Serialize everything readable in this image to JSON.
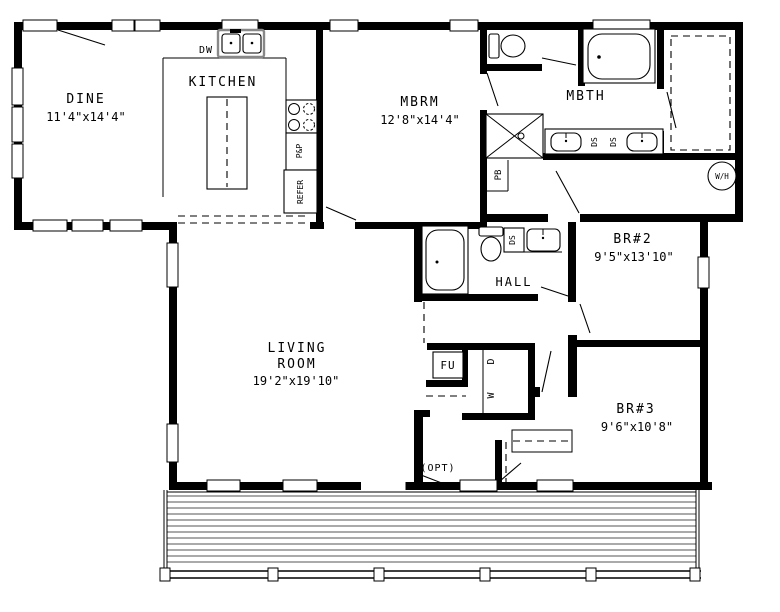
{
  "colors": {
    "line": "#000000",
    "background": "#ffffff",
    "plank": "#555555"
  },
  "rooms": {
    "dine": {
      "name": "DINE",
      "dims": "11'4\"x14'4\""
    },
    "kitchen": {
      "name": "KITCHEN"
    },
    "mbrm": {
      "name": "MBRM",
      "dims": "12'8\"x14'4\""
    },
    "mbth": {
      "name": "MBTH"
    },
    "living": {
      "name_line1": "LIVING",
      "name_line2": "ROOM",
      "dims": "19'2\"x19'10\""
    },
    "hall": {
      "name": "HALL"
    },
    "br2": {
      "name": "BR#2",
      "dims": "9'5\"x13'10\""
    },
    "br3": {
      "name": "BR#3",
      "dims": "9'6\"x10'8\""
    }
  },
  "fixtures": {
    "dishwasher": "DW",
    "pantry": "P&P",
    "refrigerator": "REFER",
    "plumbing_chase": "PB",
    "double_sink": "DS",
    "water_heater": "W/H",
    "furnace": "FU",
    "washer": "W",
    "dryer": "D",
    "optional_door": "(OPT)"
  }
}
